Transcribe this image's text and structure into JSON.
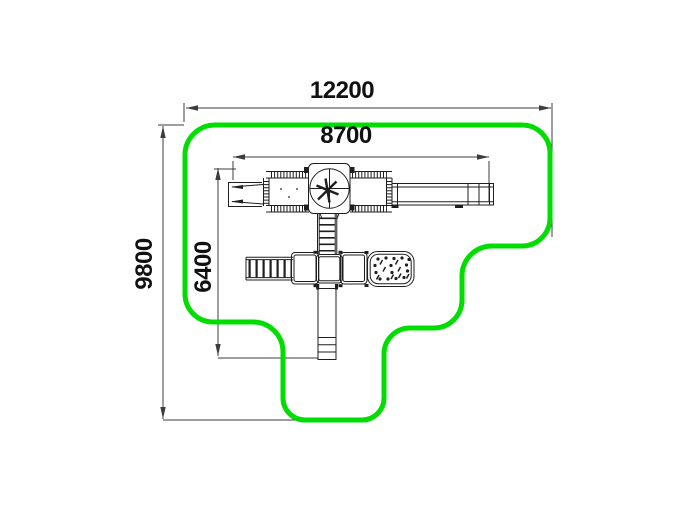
{
  "drawing": {
    "title": "playground-equipment-safety-zone-plan-top-view",
    "colors": {
      "boundary": "#00dd00",
      "line": "#1f1f1f",
      "dimension": "#3c3c3c",
      "text": "#111111"
    },
    "dimensions": {
      "overall_width": "12200",
      "inner_width": "8700",
      "overall_depth": "9800",
      "inner_depth": "6400"
    },
    "components": [
      "safety-zone-boundary",
      "double-slide",
      "bridge-walkway-left",
      "carousel-tower",
      "bridge-walkway-right",
      "balance-beam",
      "ladder",
      "monkey-bars",
      "platform-left",
      "platform-center",
      "platform-right",
      "climbing-panel",
      "straight-slide"
    ]
  }
}
